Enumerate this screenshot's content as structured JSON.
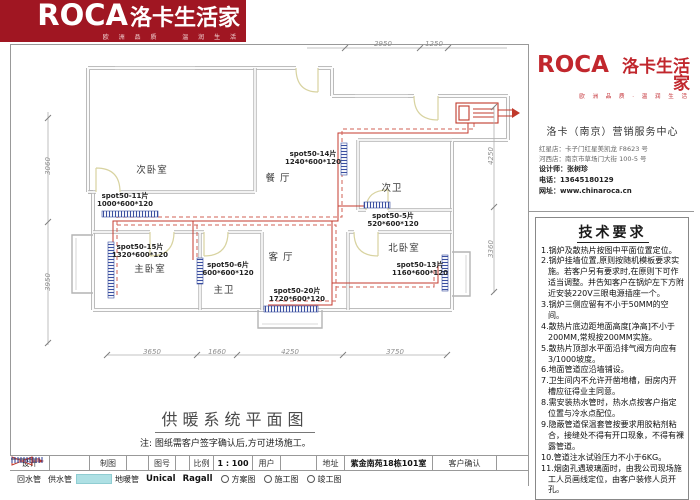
{
  "banner": {
    "brand": "ROCA",
    "brand_cn": "洛卡生活家",
    "tagline": "欧 洲 品 质 　 温 润 生 活"
  },
  "sidebar": {
    "logo_brand": "ROCA",
    "logo_brand_cn": "洛卡生活家",
    "logo_tagline": "欧 洲 品 质 · 温 润 生 活",
    "center_name": "洛卡（南京）营销服务中心",
    "store_line1": "红星店：卡子门红星美凯龙 F8623 号",
    "store_line2": "河西店：南京市草场门大街 100-5 号",
    "designer": "设计师：张树珍",
    "phone": "电话：13645180129",
    "website": "网址：www.chinaroca.cn",
    "tech_title": "技术要求",
    "tech_items": [
      "1.锅炉及散热片按图中平面位置定位。",
      "2.锅炉挂墙位置,原则按随机模板要求实施。若客户另有要求时,在原则下可作适当调整。并告知客户在锅炉左下方附近安装220V三眼电源插座一个。",
      "3.锅炉三侧应留有不小于50MM的空间。",
      "4.散热片底边距地面高度[净高]不小于200MM,常规按200MM实施。",
      "5.散热片顶部水平面沿排气阀方向应有3/1000坡度。",
      "6.地面管道应沿墙铺设。",
      "7.卫生间内不允许开凿地槽，厨房内开槽应征得业主同意。",
      "8.需安装热水管时，热水点按客户指定位置与冷水点配位。",
      "9.隐蔽管道保温套管按要求用胶粘剂粘合，接缝处不得有开口现象，不得有裸露管道。",
      "10.管道注水试验压力不小于6KG。",
      "11.烟囱孔遇玻璃面时，由我公司现场施工人员画线定位，由客户装修人员开孔。"
    ]
  },
  "plan": {
    "title": "供暖系统平面图",
    "note": "注: 图纸需客户签字确认后,方可进场施工。",
    "rooms": [
      "次卧室",
      "餐 厅",
      "次卫",
      "主卧室",
      "主卫",
      "客 厅",
      "北卧室"
    ],
    "radiators": [
      {
        "name": "spot50-11片",
        "size": "1000*600*120"
      },
      {
        "name": "spot50-15片",
        "size": "1320*600*120"
      },
      {
        "name": "spot50-14片",
        "size": "1240*600*120"
      },
      {
        "name": "spot50-5片",
        "size": "520*600*120"
      },
      {
        "name": "spot50-6片",
        "size": "600*600*120"
      },
      {
        "name": "spot50-20片",
        "size": "1720*600*120"
      },
      {
        "name": "spot50-13片",
        "size": "1160*600*120"
      }
    ],
    "dimensions": {
      "top": [
        "2950",
        "1250"
      ],
      "left": [
        "3060",
        "3950"
      ],
      "right": [
        "4250",
        "3360"
      ],
      "bottom": [
        "3650",
        "1660",
        "4250",
        "3750"
      ]
    }
  },
  "titleblock": {
    "fields": [
      {
        "label": "设计",
        "value": ""
      },
      {
        "label": "制图",
        "value": ""
      },
      {
        "label": "图号",
        "value": ""
      },
      {
        "label": "比例",
        "value": "1 : 100"
      },
      {
        "label": "用户",
        "value": ""
      },
      {
        "label": "地址",
        "value": "紫金南苑18栋101室"
      },
      {
        "label": "客户确认",
        "value": ""
      }
    ]
  },
  "legend": {
    "return_pipe": "回水管",
    "supply_pipe": "供水管",
    "floor_pipe": "地暖管",
    "unical": "Unical",
    "ragall": "Ragall",
    "option1": "方案图",
    "option2": "施工图",
    "option3": "竣工图"
  },
  "colors": {
    "brand_red": "#a01622",
    "logo_red": "#c1272d",
    "pipe_supply_red": "#c43b2f",
    "pipe_return_red": "#d06055",
    "radiator_blue": "#3a4fa0",
    "floor_pipe_cyan": "#aee0e4"
  }
}
